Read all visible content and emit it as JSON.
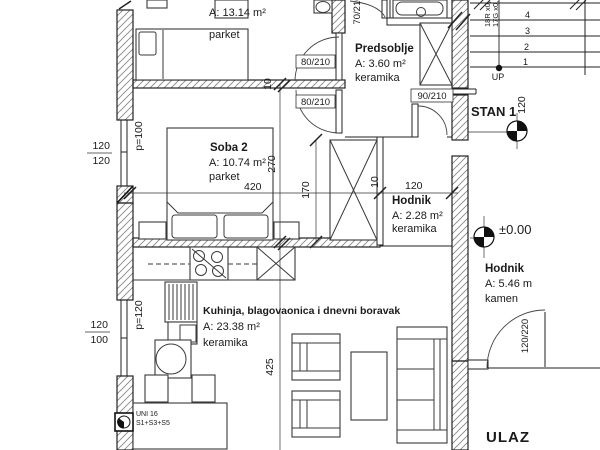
{
  "plan": {
    "title": "Floor plan - STAN 1",
    "colors": {
      "line": "#1a1a1a",
      "hatch": "#888",
      "background": "#ffffff"
    },
    "rooms": {
      "room1": {
        "area": "A: 13.14 m²",
        "floor": "parket"
      },
      "soba2": {
        "name": "Soba 2",
        "area": "A: 10.74 m²",
        "floor": "parket"
      },
      "predsoblje": {
        "name": "Predsoblje",
        "area": "A: 3.60 m²",
        "floor": "keramika"
      },
      "hodnik_small": {
        "name": "Hodnik",
        "area": "A: 2.28 m²",
        "floor": "keramika"
      },
      "hodnik_entry": {
        "name": "Hodnik",
        "area": "A: 5.46 m",
        "floor": "kamen"
      },
      "living": {
        "name": "Kuhinja, blagovaonica i dnevni boravak",
        "area": "A: 23.38 m²",
        "floor": "keramika"
      }
    },
    "markers": {
      "stan": "STAN 1",
      "level": "±0.00",
      "entry": "ULAZ",
      "up": "UP",
      "stair_r": "18R x0,",
      "stair_g": "17G x0,",
      "unit_line1": "UNI 16",
      "unit_line2": "S1+S3+S5"
    },
    "doors": {
      "d80a": "80/210",
      "d80b": "80/210",
      "d90": "90/210",
      "d70": "70/210",
      "d120": "120/220"
    },
    "dims": {
      "d420": "420",
      "d270": "270",
      "d170": "170",
      "d120h": "120",
      "d10a": "10",
      "d10b": "10",
      "d425": "425",
      "d120stair": "120",
      "win1_a": "120",
      "win1_b": "120",
      "win2_a": "120",
      "win2_b": "100",
      "p100": "p=100",
      "p120": "p=120"
    },
    "stairs": {
      "n1": "1",
      "n2": "2",
      "n3": "3",
      "n4": "4"
    }
  }
}
